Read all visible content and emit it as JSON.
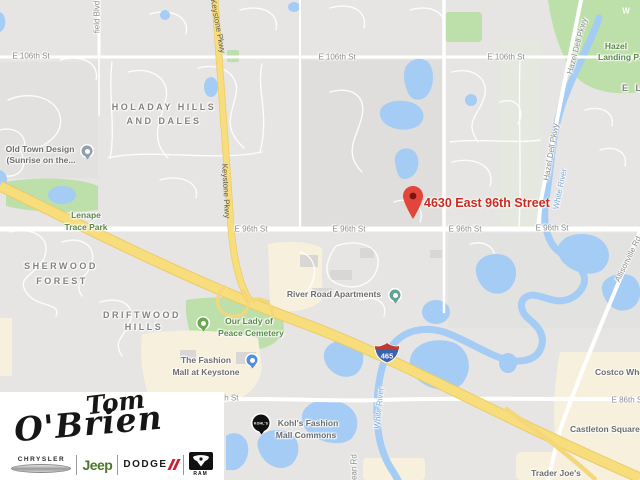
{
  "map": {
    "marker": {
      "label": "4630 East 96th Street"
    },
    "shield": "465",
    "colors": {
      "water": "#a4ccf4",
      "park": "#bddfa9",
      "commercial": "#f7f0dc",
      "highway": "#f8dd7d",
      "marker_red": "#e3453a",
      "marker_label_red": "#cb2a20"
    },
    "road_labels": [
      {
        "text": "E 106th St"
      },
      {
        "text": "E 106th St"
      },
      {
        "text": "E 106th St"
      },
      {
        "text": "E 96th St"
      },
      {
        "text": "E 96th St"
      },
      {
        "text": "E 96th St"
      },
      {
        "text": "E 96th St"
      },
      {
        "text": "E 86th St"
      },
      {
        "text": "E 86th St"
      },
      {
        "text": "Keystone Pkwy"
      },
      {
        "text": "Keystone Pkwy"
      },
      {
        "text": "Hazel Dell Pkwy"
      },
      {
        "text": "Hazel Dell Pkwy"
      },
      {
        "text": "Allisonville Rd"
      },
      {
        "text": "field Blvd"
      },
      {
        "text": "Dean Rd"
      }
    ],
    "water_labels": [
      {
        "text": "White River"
      },
      {
        "text": "White River"
      },
      {
        "text": "W"
      }
    ],
    "area_labels": [
      {
        "text": "HOLADAY HILLS"
      },
      {
        "text": "AND DALES"
      },
      {
        "text": "SHERWOOD"
      },
      {
        "text": "FOREST"
      },
      {
        "text": "DRIFTWOOD"
      },
      {
        "text": "HILLS"
      },
      {
        "text": "E L L"
      }
    ],
    "poi_labels": [
      {
        "text": "Old Town Design"
      },
      {
        "text": "(Sunrise on the..."
      },
      {
        "text": "Lenape"
      },
      {
        "text": "Trace Park"
      },
      {
        "text": "Hazel"
      },
      {
        "text": "Landing Park"
      },
      {
        "text": "Our Lady of"
      },
      {
        "text": "Peace Cemetery"
      },
      {
        "text": "River Road Apartments"
      },
      {
        "text": "The Fashion"
      },
      {
        "text": "Mall at Keystone"
      },
      {
        "text": "Kohl's Fashion"
      },
      {
        "text": "Mall Commons"
      },
      {
        "text": "Castleton Square"
      },
      {
        "text": "Costco Wholesale"
      },
      {
        "text": "Trader Joe's"
      }
    ],
    "icons": {
      "kohls_badge": "KOHL'S"
    }
  },
  "logo": {
    "script_top": "Tom",
    "script_bottom": "O'Brien",
    "brands": {
      "chrysler": "CHRYSLER",
      "jeep": "Jeep",
      "dodge": "DODGE",
      "ram": "RAM"
    }
  }
}
